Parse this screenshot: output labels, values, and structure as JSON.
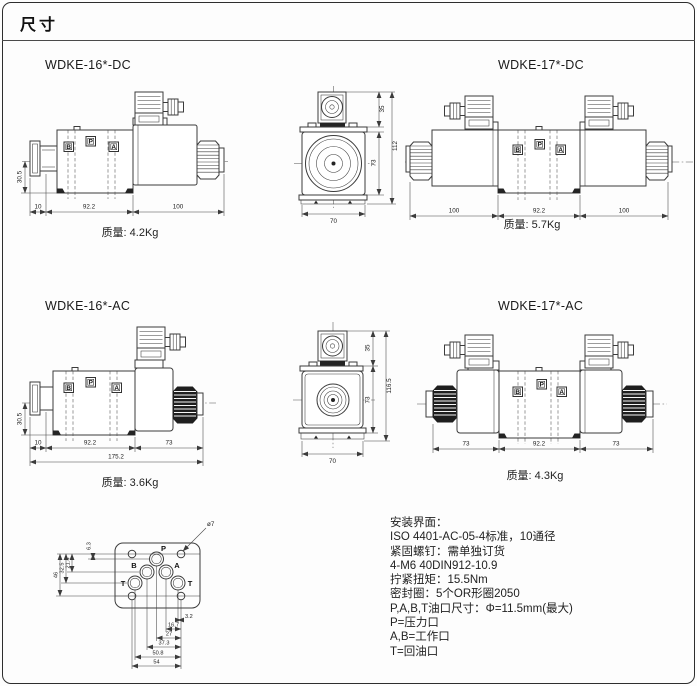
{
  "page": {
    "title": "尺寸"
  },
  "ports": {
    "p": "P",
    "a": "A",
    "b": "B",
    "t": "T"
  },
  "valves": {
    "dc16": {
      "label": "WDKE-16*-DC",
      "mass": "质量: 4.2Kg",
      "dim_height": "30.5",
      "dim_a": "10",
      "dim_b": "92.2",
      "dim_c": "100"
    },
    "dc17": {
      "label": "WDKE-17*-DC",
      "mass": "质量: 5.7Kg",
      "dim_a": "100",
      "dim_b": "92.2",
      "dim_c": "100"
    },
    "ac16": {
      "label": "WDKE-16*-AC",
      "mass": "质量: 3.6Kg",
      "dim_height": "30.5",
      "dim_a": "10",
      "dim_b": "92.2",
      "dim_c": "73",
      "dim_total": "175.2"
    },
    "ac17": {
      "label": "WDKE-17*-AC",
      "mass": "质量: 4.3Kg",
      "dim_a": "73",
      "dim_b": "92.2",
      "dim_c": "73"
    },
    "end_dc": {
      "dim_top": "35",
      "dim_body": "73",
      "dim_total": "112",
      "dim_width": "70"
    },
    "end_ac": {
      "dim_top": "35",
      "dim_body": "73",
      "dim_total": "116.5",
      "dim_width": "70"
    }
  },
  "interface": {
    "hole_note": "ø7",
    "vdims": [
      "6.3",
      "21.4",
      "32.5",
      "46"
    ],
    "hdims": [
      "3.2",
      "16.7",
      "27",
      "37.3",
      "50.8",
      "54"
    ]
  },
  "notes": {
    "lines": [
      "安装界面：",
      "ISO 4401-AC-05-4标准，10通径",
      "紧固螺钉：需单独订货",
      "4-M6 40DIN912-10.9",
      "拧紧扭矩：15.5Nm",
      "密封圈：5个OR形圈2050",
      "P,A,B,T油口尺寸：Φ=11.5mm(最大)",
      "P=压力口",
      "A,B=工作口",
      "T=回油口"
    ]
  }
}
